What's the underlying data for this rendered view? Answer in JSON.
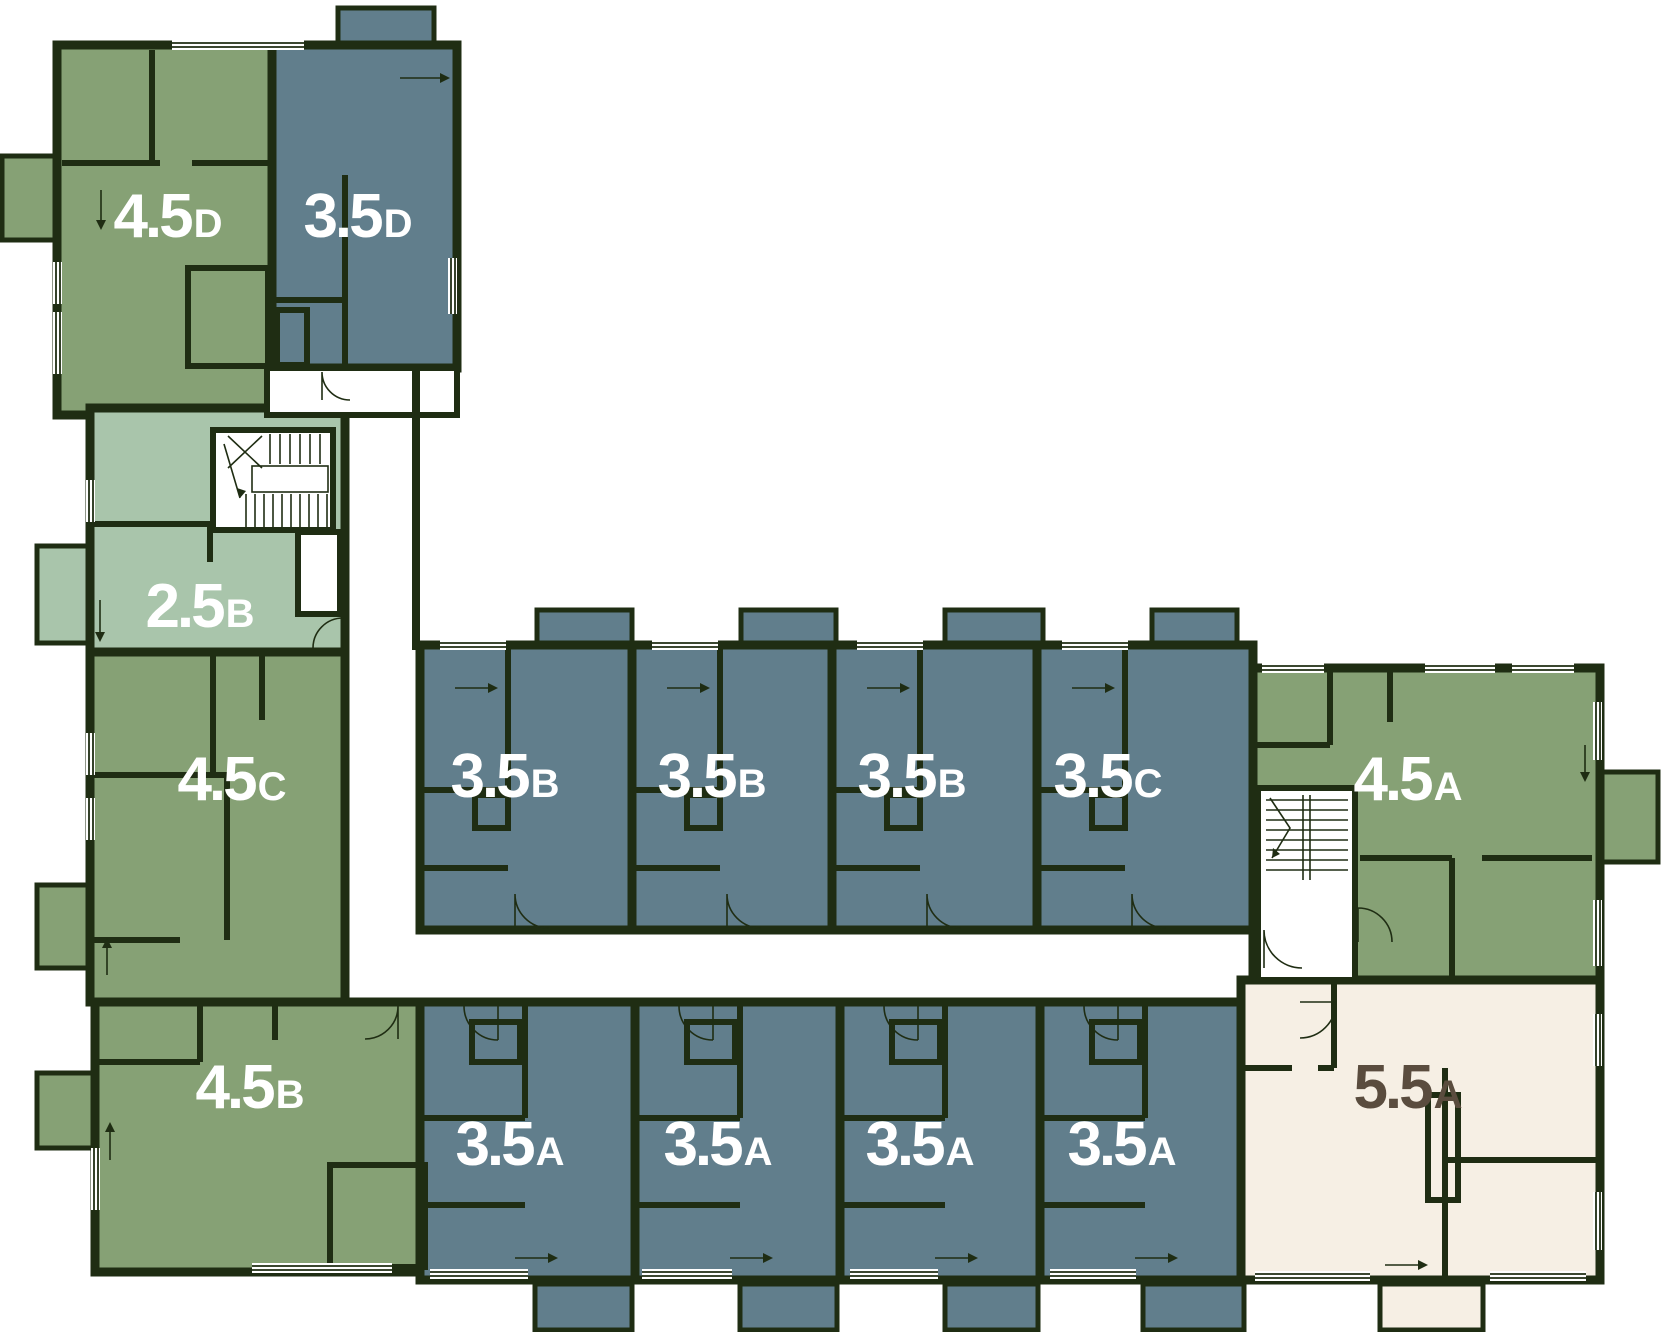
{
  "plan": {
    "background": "#ffffff",
    "wall_color": "#1f2d13",
    "colors": {
      "green": "#86a175",
      "light_green": "#a9c5ab",
      "blue": "#617e8c",
      "cream": "#f6efe4"
    },
    "label_colors": {
      "light": "#ffffff",
      "dark": "#5a4c3e"
    }
  },
  "units": [
    {
      "id": "4.5D",
      "label_main": "4.5",
      "label_suffix": "D",
      "color": "green",
      "label_color": "light"
    },
    {
      "id": "3.5D",
      "label_main": "3.5",
      "label_suffix": "D",
      "color": "blue",
      "label_color": "light"
    },
    {
      "id": "2.5B",
      "label_main": "2.5",
      "label_suffix": "B",
      "color": "light_green",
      "label_color": "light"
    },
    {
      "id": "4.5C",
      "label_main": "4.5",
      "label_suffix": "C",
      "color": "green",
      "label_color": "light"
    },
    {
      "id": "4.5B",
      "label_main": "4.5",
      "label_suffix": "B",
      "color": "green",
      "label_color": "light"
    },
    {
      "id": "3.5B",
      "label_main": "3.5",
      "label_suffix": "B",
      "color": "blue",
      "label_color": "light"
    },
    {
      "id": "3.5B",
      "label_main": "3.5",
      "label_suffix": "B",
      "color": "blue",
      "label_color": "light"
    },
    {
      "id": "3.5B",
      "label_main": "3.5",
      "label_suffix": "B",
      "color": "blue",
      "label_color": "light"
    },
    {
      "id": "3.5C",
      "label_main": "3.5",
      "label_suffix": "C",
      "color": "blue",
      "label_color": "light"
    },
    {
      "id": "4.5A",
      "label_main": "4.5",
      "label_suffix": "A",
      "color": "green",
      "label_color": "light"
    },
    {
      "id": "3.5A",
      "label_main": "3.5",
      "label_suffix": "A",
      "color": "blue",
      "label_color": "light"
    },
    {
      "id": "3.5A",
      "label_main": "3.5",
      "label_suffix": "A",
      "color": "blue",
      "label_color": "light"
    },
    {
      "id": "3.5A",
      "label_main": "3.5",
      "label_suffix": "A",
      "color": "blue",
      "label_color": "light"
    },
    {
      "id": "3.5A",
      "label_main": "3.5",
      "label_suffix": "A",
      "color": "blue",
      "label_color": "light"
    },
    {
      "id": "5.5A",
      "label_main": "5.5",
      "label_suffix": "A",
      "color": "cream",
      "label_color": "dark"
    }
  ]
}
